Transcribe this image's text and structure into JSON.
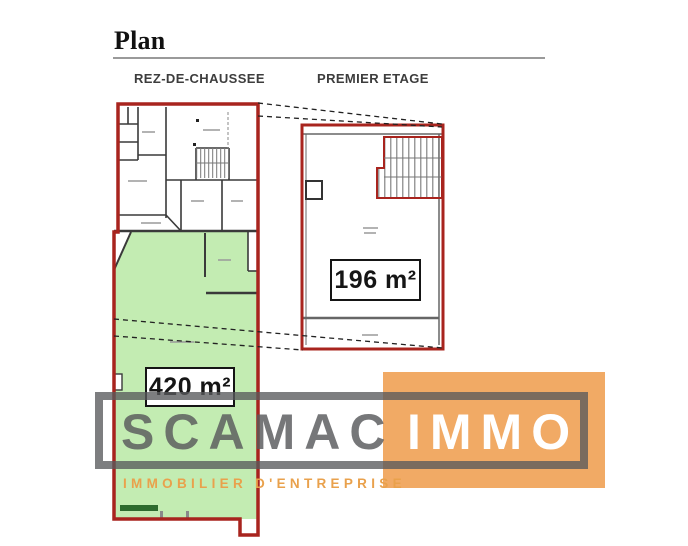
{
  "header": {
    "title": "Plan"
  },
  "floors": {
    "ground": {
      "label": "REZ-DE-CHAUSSEE",
      "area_label": "420 m²"
    },
    "first": {
      "label": "PREMIER ETAGE",
      "area_label": "196 m²"
    }
  },
  "watermark": {
    "brand_primary": "SCAMAC",
    "brand_secondary": "IMMO",
    "tagline": "IMMOBILIER D'ENTREPRISE"
  },
  "colors": {
    "plan_outline_red": "#a8241e",
    "highlight_green": "#c3ecb2",
    "dark_green_bar": "#2e6b2e",
    "wall_gray": "#3a3a3a",
    "logo_orange": "#f0a75f",
    "logo_frame_gray": "#595a5c",
    "tagline_orange": "#e9a14c"
  }
}
